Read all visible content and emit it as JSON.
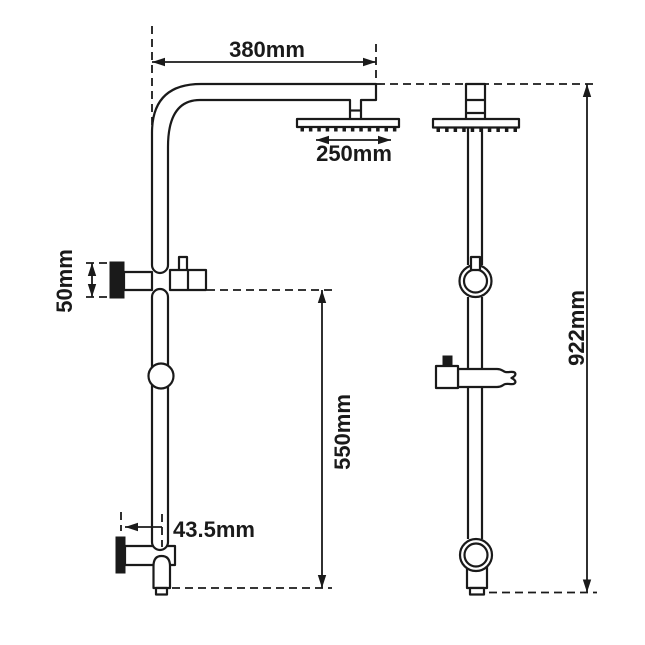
{
  "drawing": {
    "background": "#ffffff",
    "line_color": "#1a1a1a",
    "dimensions": {
      "arm_reach": "380mm",
      "head_diameter": "250mm",
      "bracket_size": "50mm",
      "lower_rail_span": "550mm",
      "bottom_offset": "43.5mm",
      "overall_height": "922mm"
    }
  }
}
